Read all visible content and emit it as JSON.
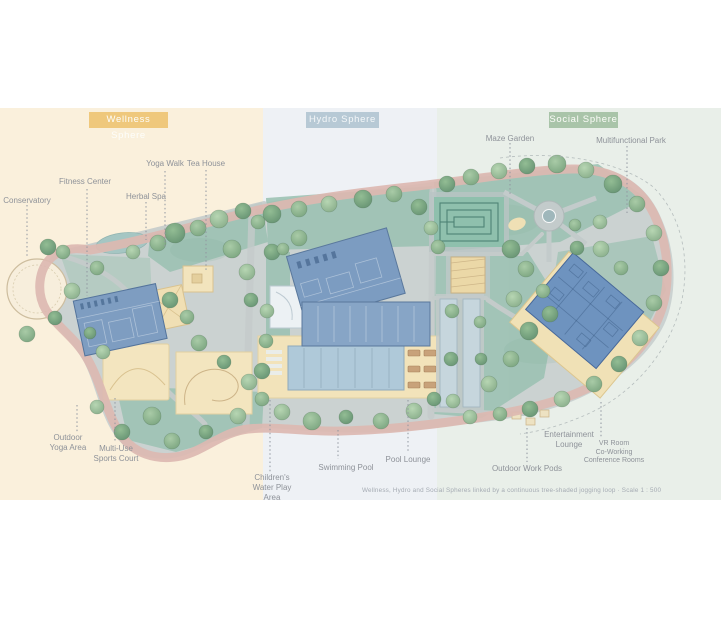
{
  "zones": [
    {
      "label": "Wellness Sphere",
      "badge_color": "#EFC87C",
      "band_color": "#FAF0DC"
    },
    {
      "label": "Hydro Sphere",
      "badge_color": "#B7C9D5",
      "band_color": "#EEF1F5"
    },
    {
      "label": "Social Sphere",
      "badge_color": "#A9C4A9",
      "band_color": "#E9EFE9"
    }
  ],
  "labels": [
    {
      "text": "Conservatory"
    },
    {
      "text": "Fitness Center"
    },
    {
      "text": "Herbal Spa"
    },
    {
      "text": "Yoga Walk"
    },
    {
      "text": "Tea House"
    },
    {
      "text": "Outdoor\nYoga Area"
    },
    {
      "text": "Multi-Use\nSports Court"
    },
    {
      "text": "Children's\nWater Play\nArea"
    },
    {
      "text": "Swimming Pool"
    },
    {
      "text": "Pool Lounge"
    },
    {
      "text": "Maze Garden"
    },
    {
      "text": "Multifunctional Park"
    },
    {
      "text": "Entertainment\nLounge"
    },
    {
      "text": "VR Room\nCo-Working\nConference Rooms"
    },
    {
      "text": "Outdoor Work Pods"
    }
  ],
  "caption": "Wellness, Hydro and Social Spheres linked by a continuous tree-shaded jogging loop · Scale 1 : 500",
  "colors": {
    "jogging_loop": "#DCB8B1",
    "building_blue": "#7E9DC1",
    "deck_beige": "#F2E3BA",
    "lawn_green": "#9CC2B3",
    "pool_water": "#AFC9D9",
    "maze_green": "#8FC0AD",
    "road_grey": "#C4CBCA"
  }
}
